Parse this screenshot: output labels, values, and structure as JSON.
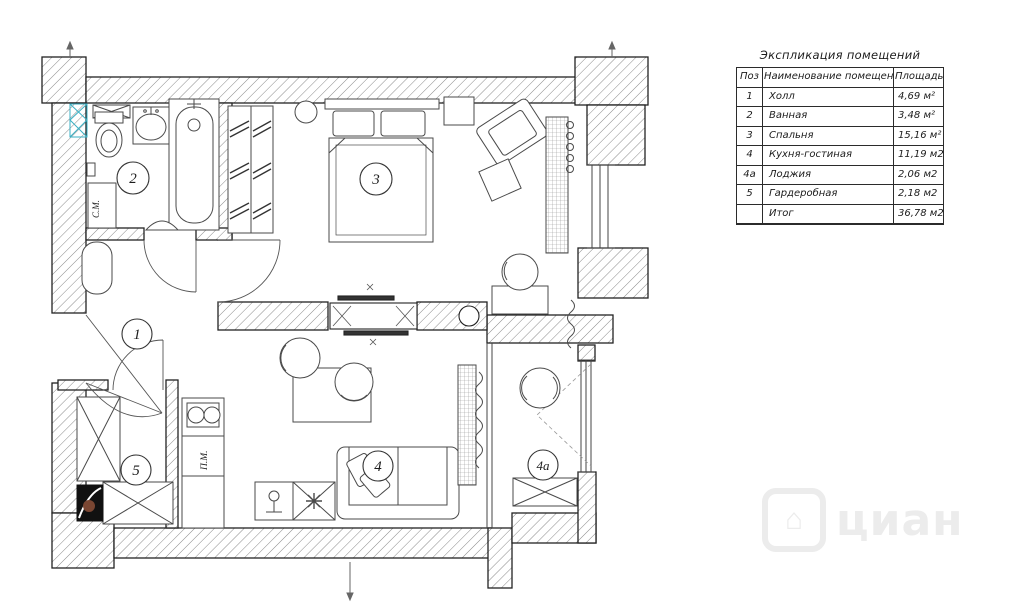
{
  "plan": {
    "room_labels": [
      {
        "id": "hall",
        "number": "1"
      },
      {
        "id": "bathroom",
        "number": "2"
      },
      {
        "id": "bedroom",
        "number": "3"
      },
      {
        "id": "kitchen-living",
        "number": "4"
      },
      {
        "id": "loggia",
        "number": "4а"
      },
      {
        "id": "wardrobe-room",
        "number": "5"
      }
    ],
    "appliance_labels": {
      "washing_machine": "С.М.",
      "dishwasher": "П.М."
    },
    "watermark": "циан",
    "watermark_icon": "⌂"
  },
  "table": {
    "title": "Экспликация помещений",
    "headers": {
      "pos": "Поз",
      "name": "Наименование помещений",
      "area": "Площадь"
    },
    "rows": [
      {
        "pos": "1",
        "name": "Холл",
        "area": "4,69 м²"
      },
      {
        "pos": "2",
        "name": "Ванная",
        "area": "3,48 м²"
      },
      {
        "pos": "3",
        "name": "Спальня",
        "area": "15,16 м²"
      },
      {
        "pos": "4",
        "name": "Кухня-гостиная",
        "area": "11,19 м2"
      },
      {
        "pos": "4а",
        "name": "Лоджия",
        "area": "2,06 м2"
      },
      {
        "pos": "5",
        "name": "Гардеробная",
        "area": "2,18 м2"
      },
      {
        "pos": "",
        "name": "Итог",
        "area": "36,78 м2"
      }
    ]
  },
  "colors": {
    "wall_hatch_line": "#8a8a8a",
    "outline": "#222222",
    "accent_cyan": "#3ab0c4",
    "watermark_gray": "#ececec",
    "safe_dot_brown": "#7a4632"
  }
}
